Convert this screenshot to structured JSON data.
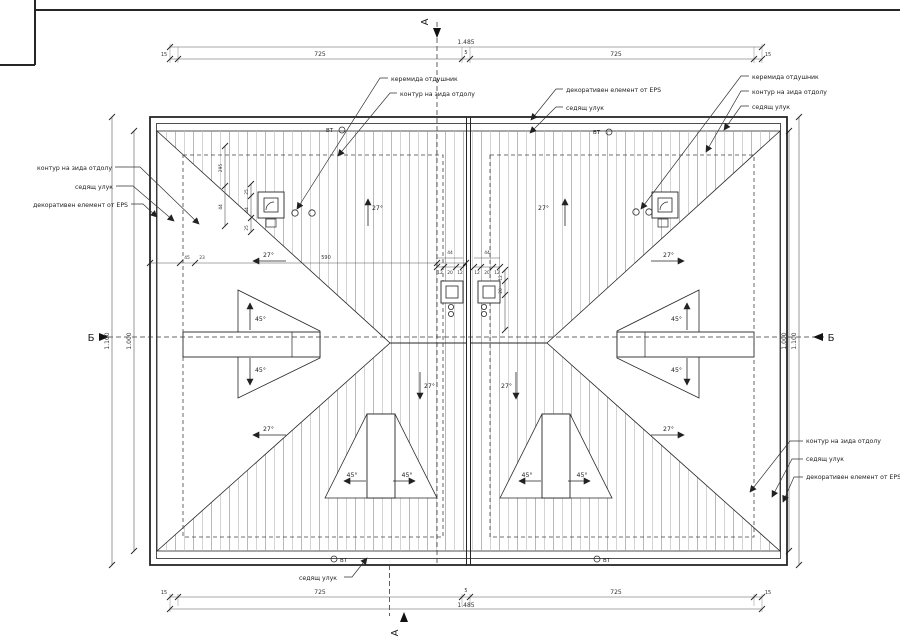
{
  "callouts": {
    "tile_vent": "керемида отдушник",
    "wall_contour": "контур на зида отдолу",
    "gutter": "седящ улук",
    "eps": "декоративен елемент от EPS"
  },
  "dims": {
    "total": "1.485",
    "segment": "725",
    "gap": "5",
    "edge": "15",
    "d590": "590",
    "d45": "45",
    "d23": "23",
    "d44": "44",
    "d12": "12",
    "d20": "20",
    "d25": "25",
    "d295": "295",
    "v_outer": "1.100",
    "v_inner": "1.000"
  },
  "angles": {
    "main": "27°",
    "dormer": "45°"
  },
  "markers": {
    "section_a": "А",
    "section_b": "Б",
    "vent": "ВТ"
  }
}
